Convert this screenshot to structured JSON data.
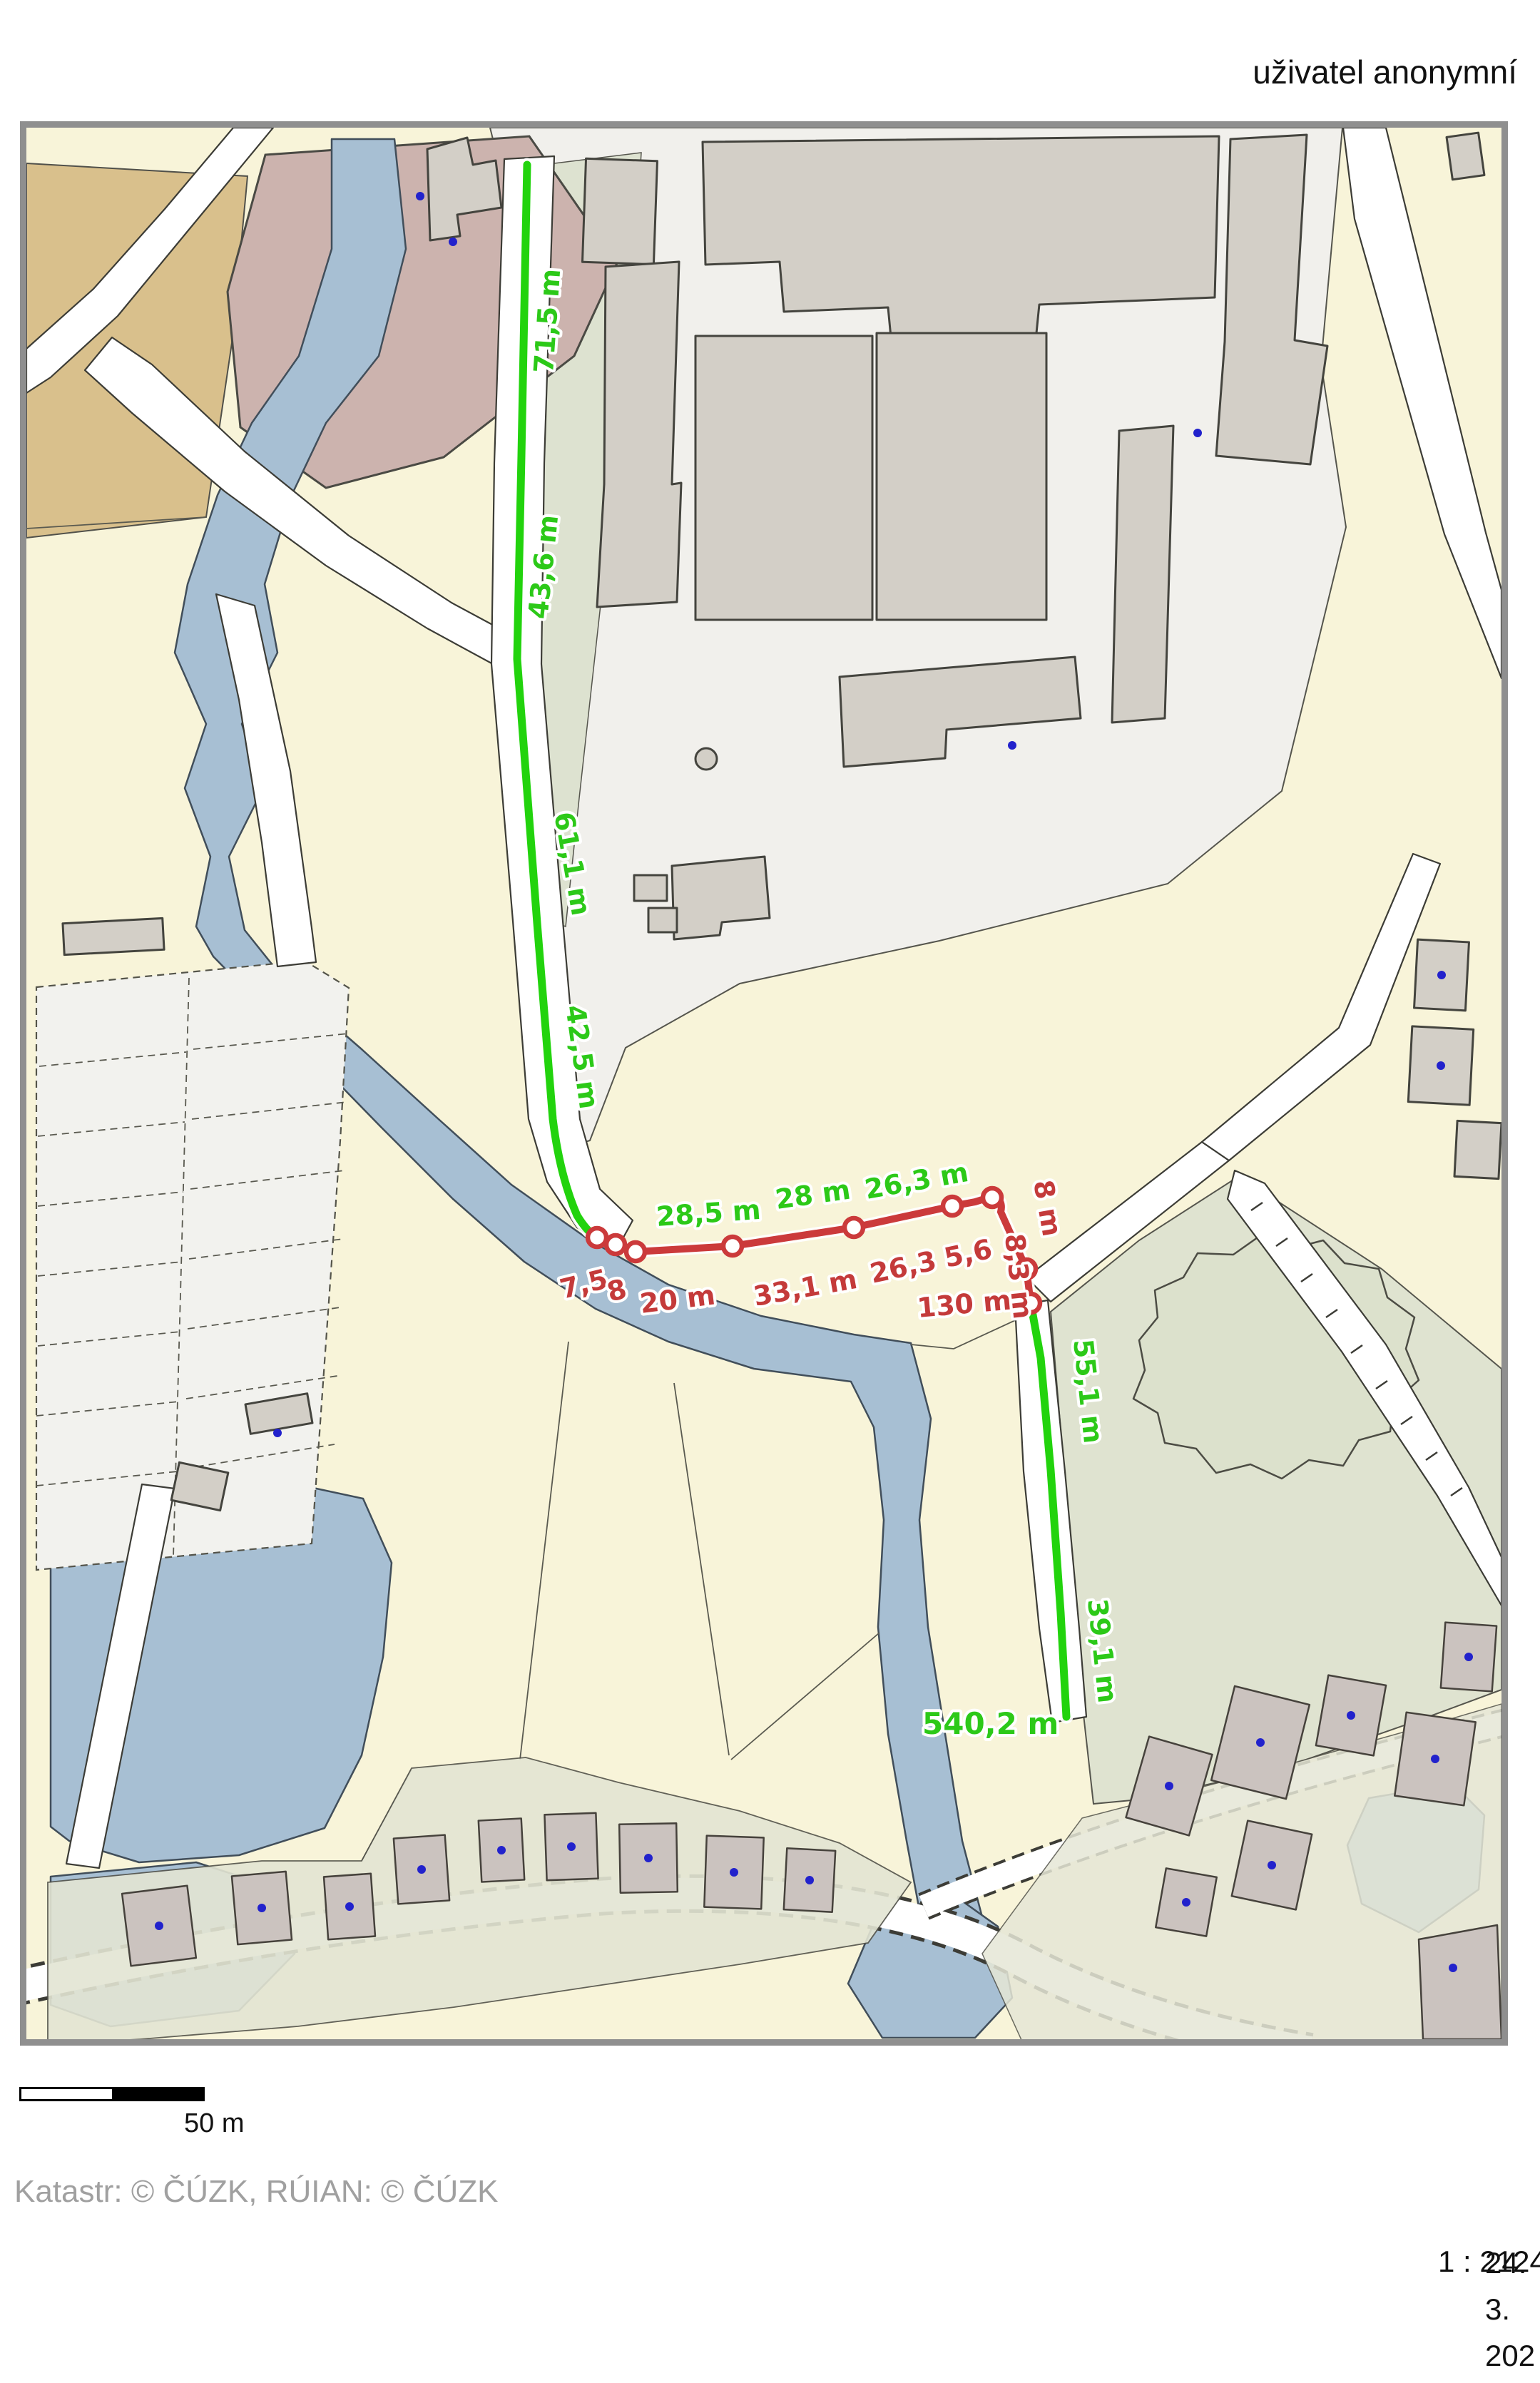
{
  "header": {
    "user": "uživatel anonymní"
  },
  "map": {
    "measurements": {
      "green": {
        "segments": [
          "71,5 m",
          "43,6 m",
          "61,1 m",
          "42,5 m",
          "28,5 m",
          "28 m",
          "26,3 m",
          "55,1 m",
          "39,1 m"
        ],
        "total": "540,2 m",
        "line_color": "#22d30d",
        "label_color": "#2cc918"
      },
      "red": {
        "segments": [
          "7,5",
          "8",
          "20 m",
          "33,1 m",
          "26,3",
          "5,6",
          "8 m",
          "8,3 m",
          "130 m"
        ],
        "line_color": "#cb3a3b",
        "label_color": "#c43a3a"
      }
    },
    "colors": {
      "parcel_cream": "#f8f4d9",
      "industrial_zone": "#f1f0ec",
      "building_gray": "#d3cfc7",
      "water_blue": "#a7bfd3",
      "olive_green": "#dfe3d0",
      "village_olive": "#e3e5d3",
      "house_gray": "#cbc3bf",
      "pink_building": "#ccb3ae",
      "tan_parcel": "#d9c08c",
      "road_white": "#ffffff",
      "point_blue": "#2222cc",
      "frame_gray": "#8f8f8f"
    }
  },
  "scalebar": {
    "label": "50 m"
  },
  "attribution": "Katastr: © ČÚZK, RÚIAN: © ČÚZK",
  "footer": {
    "scale": "1 : 2124",
    "date_visible": "24. 3. 202"
  }
}
